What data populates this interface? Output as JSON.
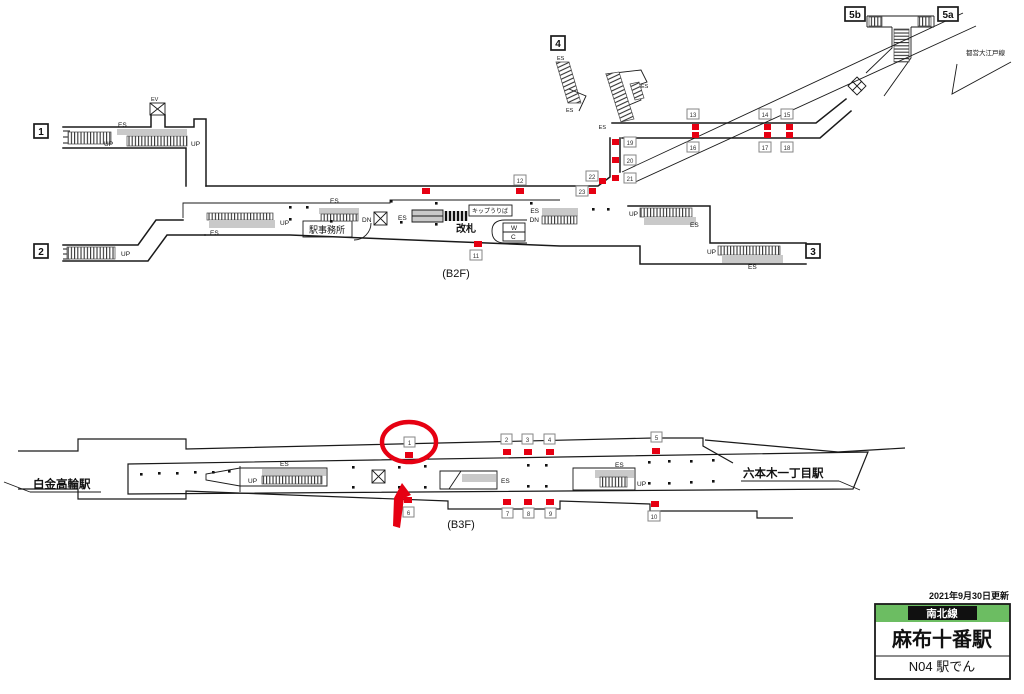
{
  "station": {
    "updated": "2021年9月30日更新",
    "line": "南北線",
    "name": "麻布十番駅",
    "code_row": "N04 駅でん"
  },
  "floors": {
    "b2f": "(B2F)",
    "b3f": "(B3F)"
  },
  "neighbors": {
    "left": "白金高輪駅",
    "right": "六本木一丁目駅"
  },
  "other_line": {
    "name": "都営大江戸線"
  },
  "exits": {
    "e1": "1",
    "e2": "2",
    "e3": "3",
    "e4": "4",
    "e5a": "5a",
    "e5b": "5b"
  },
  "rooms": {
    "office": "駅事務所",
    "gate": "改札",
    "ticket": "キップうりば",
    "toilet_w": "W",
    "toilet_c": "C"
  },
  "markers": {
    "ev": "EV",
    "es": "ES",
    "up": "UP",
    "dn": "DN"
  },
  "signs_b3f": [
    "1",
    "2",
    "3",
    "4",
    "5",
    "6",
    "7",
    "8",
    "9",
    "10"
  ],
  "signs_b2f": [
    "11",
    "12",
    "13",
    "14",
    "15",
    "16",
    "17",
    "18",
    "19",
    "20",
    "21",
    "22",
    "23"
  ],
  "colors": {
    "red": "#e60012",
    "line_green": "#6cbd62",
    "wall": "#1a1a1a",
    "grey": "#c9c9c9"
  }
}
